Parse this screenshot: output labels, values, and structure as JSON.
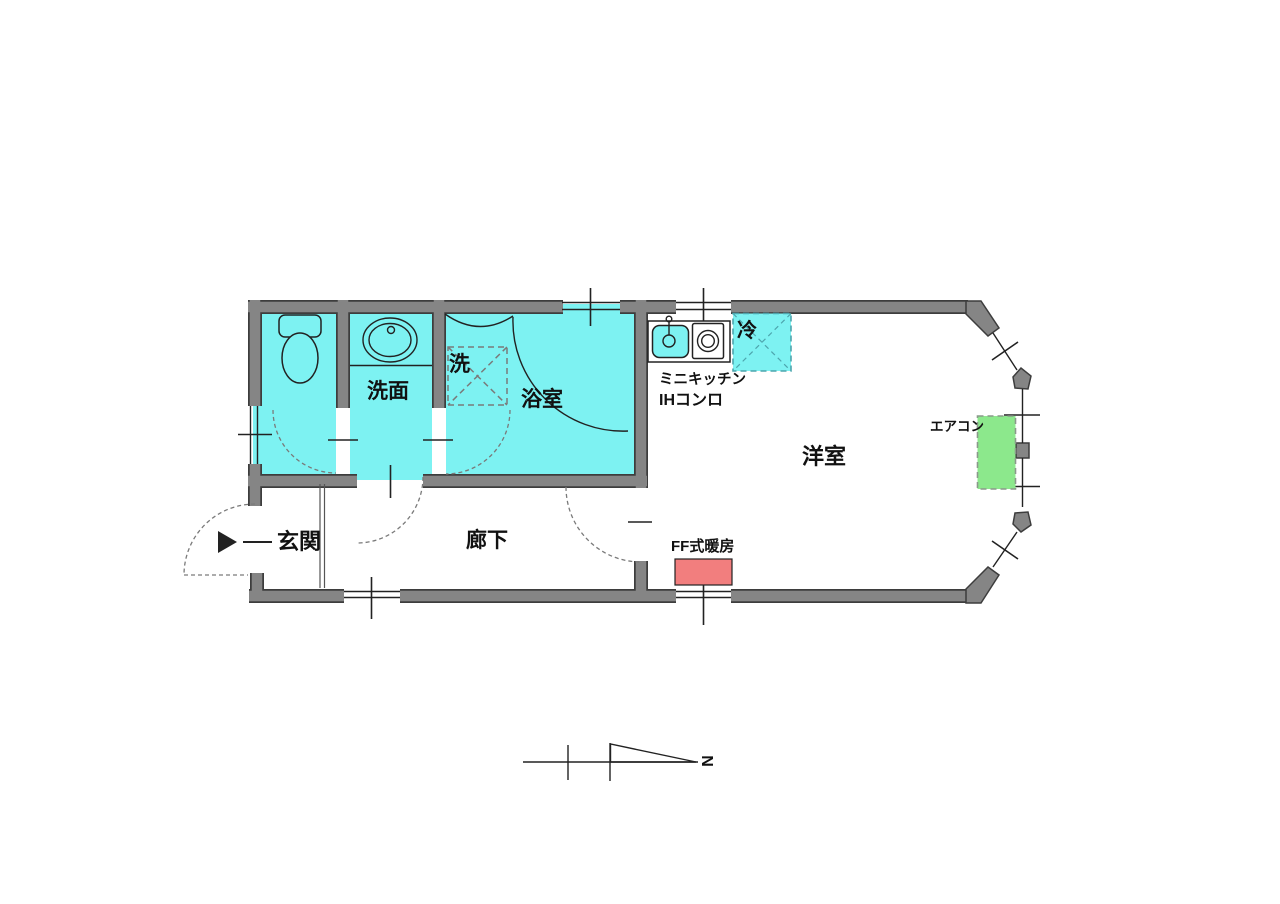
{
  "document": {
    "type": "apartment-floor-plan",
    "description": "Japanese one-room apartment floor plan with sanitary block, mini kitchen, corridor and western-style room with bay window"
  },
  "labels": {
    "entrance": "玄関",
    "corridor": "廊下",
    "western_room": "洋室",
    "washroom": "洗面",
    "bathroom": "浴室",
    "washer": "洗",
    "fridge": "冷",
    "mini_kitchen": "ミニキッチン",
    "ih_stove": "IHコンロ",
    "ff_heater": "FF式暖房",
    "aircon": "エアコン",
    "compass_north": "N"
  },
  "colors": {
    "wall_fill": "#858585",
    "wall_edge": "#3d3d3d",
    "room_cyan": "#7df2f2",
    "fixture_line": "#222222",
    "dash_gray": "#7a7a7a",
    "fridge_dash": "#4da5ad",
    "aircon_green": "#8ce88c",
    "aircon_dash": "#8a9a8a",
    "heater_red": "#f27e7e",
    "step_line": "#555555",
    "text": "#111111"
  }
}
